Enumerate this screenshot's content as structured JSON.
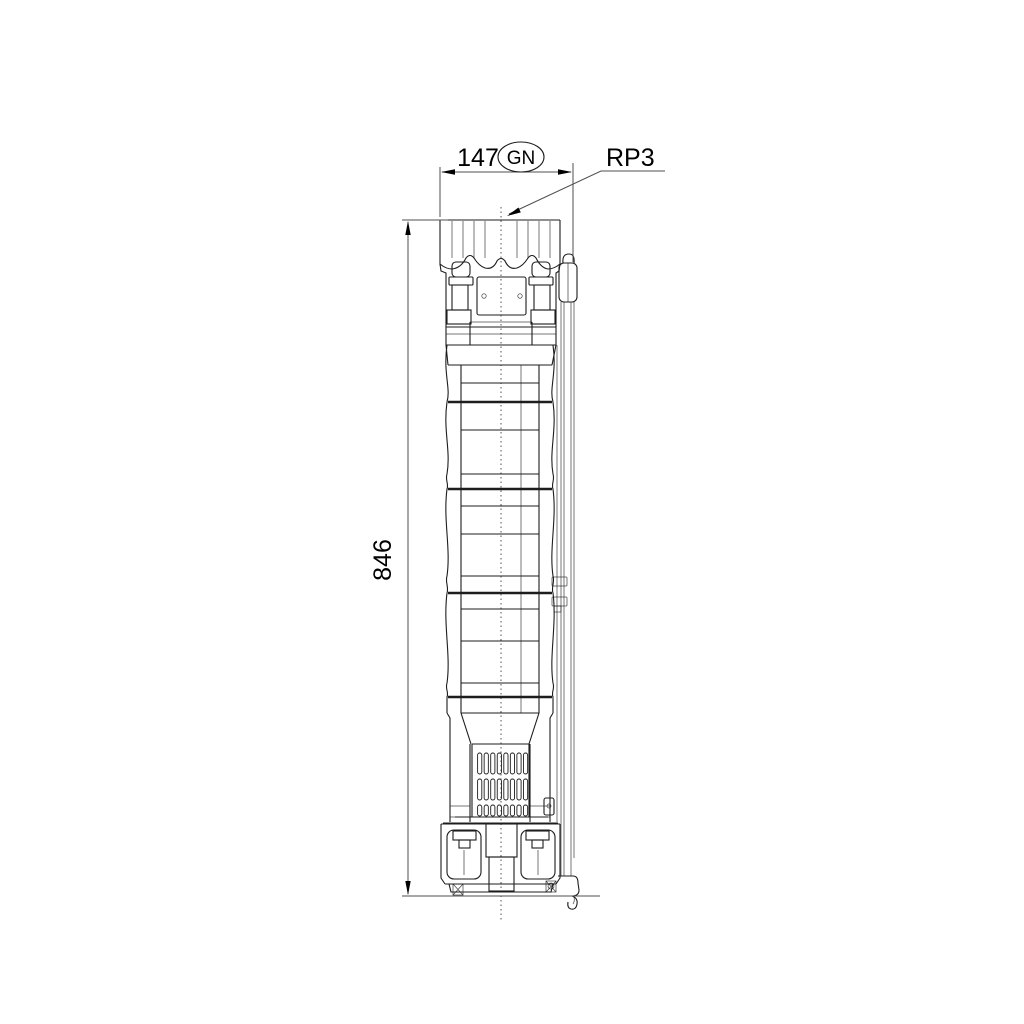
{
  "drawing": {
    "width_dimension": {
      "value": "147"
    },
    "width_tag": {
      "label": "GN"
    },
    "outlet_connection": {
      "label": "RP3"
    },
    "height_dimension": {
      "value": "846"
    },
    "colors": {
      "background": "#ffffff",
      "drawing_line": "#1d1d1d",
      "dimension_line": "#4f4f4f",
      "text": "#000000"
    }
  }
}
